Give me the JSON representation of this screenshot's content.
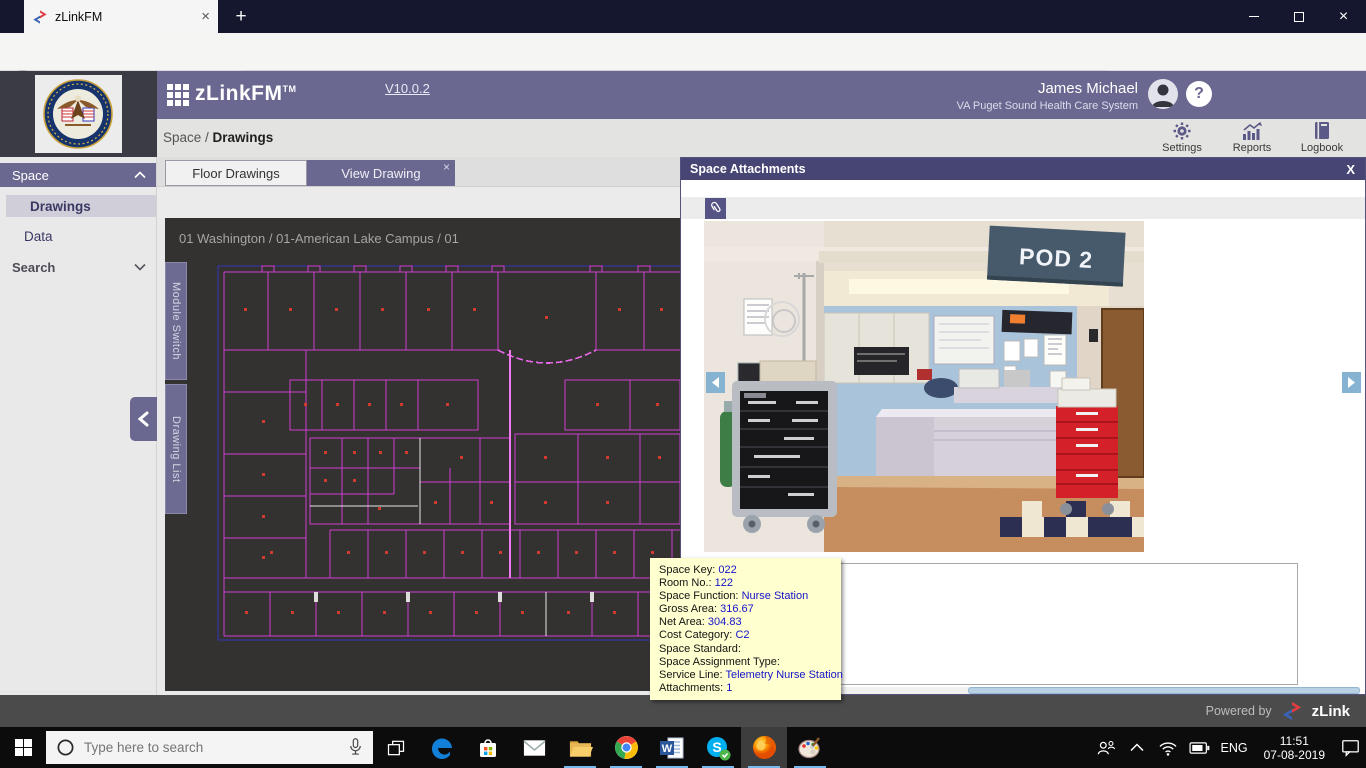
{
  "glyphs": {
    "tab_close": "×",
    "new_tab": "+",
    "window_close": "×",
    "overflow_dots": "···",
    "star": "☆",
    "help": "?",
    "modal_close": "X",
    "back_chevron": "‹",
    "forward_chevron": "›"
  },
  "browser": {
    "tab": {
      "title": "zLinkFM"
    },
    "address": {
      "identity": "zLink Inc. (US)",
      "url_prefix": "https://demo.",
      "url_domain": "zlinkfm.com",
      "url_path": "/zLinkFMV10/space/drawings",
      "zoom_level": "90%"
    }
  },
  "app": {
    "brand": {
      "name": "zLinkFM",
      "tm": "TM",
      "version": "V10.0.2"
    },
    "user": {
      "name": "James Michael",
      "org": "VA Puget Sound Health Care System"
    },
    "crumb": {
      "section": "Space",
      "sep": " / ",
      "current": "Drawings"
    },
    "header_actions": [
      {
        "label": "Settings"
      },
      {
        "label": "Reports"
      },
      {
        "label": "Logbook"
      }
    ],
    "sidebar": {
      "group1": "Space",
      "item_drawings": "Drawings",
      "item_data": "Data",
      "group2": "Search"
    },
    "tabs": {
      "floor_drawings": "Floor Drawings",
      "view_drawing": "View Drawing"
    },
    "drawing": {
      "location_breadcrumb": "01 Washington / 01-American Lake Campus / 01",
      "vertical_tab_top": "Module Switch",
      "vertical_tab_bottom": "Drawing List"
    },
    "modal": {
      "title": "Space Attachments",
      "photo": {
        "sign_text": "POD 2"
      }
    },
    "tooltip": {
      "rows": [
        {
          "label": "Space Key:",
          "value": "022"
        },
        {
          "label": "Room No.:",
          "value": "122"
        },
        {
          "label": "Space Function:",
          "value": "Nurse Station"
        },
        {
          "label": "Gross Area:",
          "value": "316.67"
        },
        {
          "label": "Net Area:",
          "value": "304.83"
        },
        {
          "label": "Cost Category:",
          "value": "C2"
        },
        {
          "label": "Space Standard:",
          "value": ""
        },
        {
          "label": "Space Assignment Type:",
          "value": ""
        },
        {
          "label": "Service Line:",
          "value": "Telemetry Nurse Station"
        },
        {
          "label": "Attachments:",
          "value": "1"
        }
      ]
    },
    "footer": {
      "powered_by": "Powered by",
      "brand": "zLink"
    }
  },
  "taskbar": {
    "search_placeholder": "Type here to search",
    "tray": {
      "language": "ENG",
      "time": "11:51",
      "date": "07-08-2019"
    }
  },
  "colors": {
    "app_purple": "#6a6890",
    "modal_header_purple": "#474573",
    "cad_wall_magenta": "#cf3ecf",
    "cad_background": "#333231",
    "tooltip_bg": "#ffffcf",
    "tooltip_value_blue": "#1414cc",
    "identity_green": "#058b00"
  }
}
